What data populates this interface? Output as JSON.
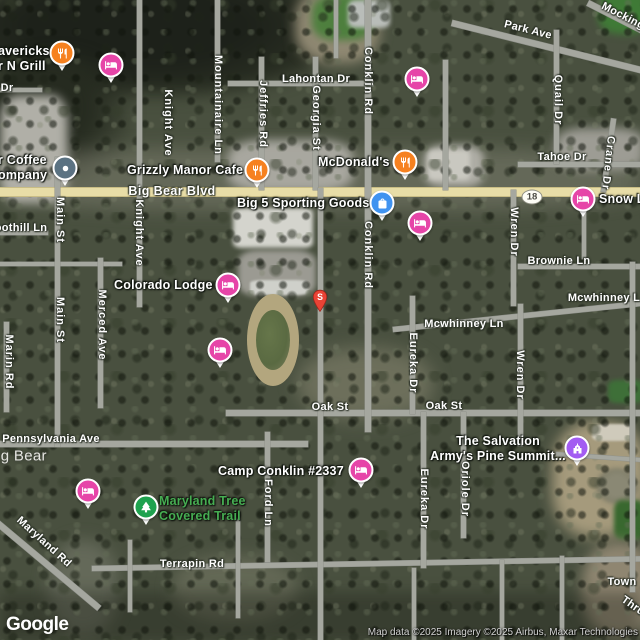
{
  "map": {
    "watermark": "Google",
    "attribution": "Map data ©2025 Imagery ©2025 Airbus, Maxar Technologies",
    "route_shield": {
      "number": "18",
      "x": 532,
      "y": 197
    },
    "colors": {
      "road_major": "#e8dda7",
      "road_minor": "#a5a79f",
      "pin_lodging": "#e645a8",
      "pin_restaurant": "#f68120",
      "pin_shopping": "#4093f0",
      "pin_generic": "#5b7282",
      "pin_worship": "#a35cf2",
      "pin_park": "#1fa24f",
      "marker_red": "#ea4335",
      "trail_label_green": "#46ad52",
      "city_label": "#e6e6e2"
    },
    "street_labels": [
      {
        "text": "Dr",
        "x": 7,
        "y": 88,
        "o": "h"
      },
      {
        "text": "Park Ave",
        "x": 528,
        "y": 30,
        "o": "h",
        "rot": 14
      },
      {
        "text": "Mocking",
        "x": 623,
        "y": 16,
        "o": "h",
        "rot": 27
      },
      {
        "text": "Lahontan Dr",
        "x": 316,
        "y": 79,
        "o": "h"
      },
      {
        "text": "Mountainaire Ln",
        "x": 218,
        "y": 105,
        "o": "v"
      },
      {
        "text": "Knight Ave",
        "x": 168,
        "y": 123,
        "o": "v"
      },
      {
        "text": "Jeffries Rd",
        "x": 263,
        "y": 114,
        "o": "v"
      },
      {
        "text": "Georgia St",
        "x": 316,
        "y": 118,
        "o": "v"
      },
      {
        "text": "Conklin Rd",
        "x": 368,
        "y": 81,
        "o": "v"
      },
      {
        "text": "Quail Dr",
        "x": 558,
        "y": 100,
        "o": "v"
      },
      {
        "text": "Tahoe Dr",
        "x": 562,
        "y": 157,
        "o": "h"
      },
      {
        "text": "Crane Dr",
        "x": 608,
        "y": 163,
        "o": "v",
        "rot": 6
      },
      {
        "text": "Big Bear Blvd",
        "x": 172,
        "y": 191,
        "o": "h",
        "variant": "major"
      },
      {
        "text": "oothill Ln",
        "x": 21,
        "y": 228,
        "o": "h"
      },
      {
        "text": "Main St",
        "x": 60,
        "y": 220,
        "o": "v"
      },
      {
        "text": "Knight Ave",
        "x": 139,
        "y": 233,
        "o": "v"
      },
      {
        "text": "Conklin Rd",
        "x": 368,
        "y": 255,
        "o": "v"
      },
      {
        "text": "Wren Dr",
        "x": 514,
        "y": 232,
        "o": "v"
      },
      {
        "text": "Brownie Ln",
        "x": 559,
        "y": 261,
        "o": "h"
      },
      {
        "text": "Mcwhinney L",
        "x": 604,
        "y": 298,
        "o": "h"
      },
      {
        "text": "Mcwhinney Ln",
        "x": 464,
        "y": 324,
        "o": "h"
      },
      {
        "text": "Main St",
        "x": 60,
        "y": 320,
        "o": "v"
      },
      {
        "text": "Merced Ave",
        "x": 102,
        "y": 325,
        "o": "v"
      },
      {
        "text": "Marin Rd",
        "x": 9,
        "y": 362,
        "o": "v"
      },
      {
        "text": "Eureka Dr",
        "x": 413,
        "y": 363,
        "o": "v"
      },
      {
        "text": "Wren Dr",
        "x": 520,
        "y": 375,
        "o": "v"
      },
      {
        "text": "Oak St",
        "x": 330,
        "y": 407,
        "o": "h"
      },
      {
        "text": "Oak St",
        "x": 444,
        "y": 406,
        "o": "h"
      },
      {
        "text": "Pennsylvania Ave",
        "x": 51,
        "y": 439,
        "o": "h"
      },
      {
        "text": "ig Bear",
        "x": 22,
        "y": 456,
        "o": "h",
        "variant": "city"
      },
      {
        "text": "Ford Ln",
        "x": 268,
        "y": 503,
        "o": "v"
      },
      {
        "text": "Eureka Dr",
        "x": 424,
        "y": 499,
        "o": "v"
      },
      {
        "text": "Oriole Dr",
        "x": 465,
        "y": 489,
        "o": "v"
      },
      {
        "text": "Maryland Rd",
        "x": 44,
        "y": 542,
        "o": "h",
        "rot": 42
      },
      {
        "text": "Terrapin Rd",
        "x": 192,
        "y": 564,
        "o": "h"
      },
      {
        "text": "Town",
        "x": 622,
        "y": 582,
        "o": "h"
      },
      {
        "text": "Thru",
        "x": 633,
        "y": 606,
        "o": "h",
        "rot": 35
      }
    ],
    "poi_labels": [
      {
        "name": "mavericks-grill-label",
        "lines": [
          "avericks",
          "r N Grill"
        ],
        "x": -2,
        "y": 44
      },
      {
        "name": "coffee-company-label",
        "lines": [
          "r Coffee",
          "ompany"
        ],
        "x": -2,
        "y": 153
      },
      {
        "name": "grizzly-manor-cafe-label",
        "lines": [
          "Grizzly Manor Cafe"
        ],
        "x": 127,
        "y": 163
      },
      {
        "name": "big5-sporting-goods-label",
        "lines": [
          "Big 5 Sporting Goods"
        ],
        "x": 237,
        "y": 196
      },
      {
        "name": "mcdonalds-label",
        "lines": [
          "McDonald's"
        ],
        "x": 318,
        "y": 155
      },
      {
        "name": "snow-lodge-label",
        "lines": [
          "Snow L"
        ],
        "x": 599,
        "y": 192
      },
      {
        "name": "colorado-lodge-label",
        "lines": [
          "Colorado Lodge"
        ],
        "x": 114,
        "y": 278
      },
      {
        "name": "camp-conklin-label",
        "lines": [
          "Camp Conklin #2337"
        ],
        "x": 218,
        "y": 464
      },
      {
        "name": "salvation-army-label",
        "lines": [
          "The Salvation",
          "Army's Pine Summit..."
        ],
        "x": 428,
        "y": 434,
        "w": 140,
        "align": "center"
      },
      {
        "name": "maryland-trail-label",
        "lines": [
          "Maryland Tree",
          "Covered Trail"
        ],
        "x": 159,
        "y": 494,
        "variant": "green"
      }
    ],
    "pins": [
      {
        "name": "mavericks-grill",
        "icon": "restaurant-icon",
        "color": "pin_restaurant",
        "x": 62,
        "y": 53
      },
      {
        "name": "lodging-1",
        "icon": "bed-icon",
        "color": "pin_lodging",
        "x": 111,
        "y": 65
      },
      {
        "name": "lodging-2",
        "icon": "bed-icon",
        "color": "pin_lodging",
        "x": 417,
        "y": 79
      },
      {
        "name": "coffee-company",
        "icon": "dot-icon",
        "color": "pin_generic",
        "x": 65,
        "y": 168
      },
      {
        "name": "grizzly-manor-cafe",
        "icon": "restaurant-icon",
        "color": "pin_restaurant",
        "x": 257,
        "y": 170
      },
      {
        "name": "mcdonalds",
        "icon": "restaurant-icon",
        "color": "pin_restaurant",
        "x": 405,
        "y": 162
      },
      {
        "name": "snow-lodge",
        "icon": "bed-icon",
        "color": "pin_lodging",
        "x": 583,
        "y": 199
      },
      {
        "name": "big5-sporting-goods",
        "icon": "shopping-bag-icon",
        "color": "pin_shopping",
        "x": 382,
        "y": 203
      },
      {
        "name": "lodging-3",
        "icon": "bed-icon",
        "color": "pin_lodging",
        "x": 420,
        "y": 223
      },
      {
        "name": "colorado-lodge",
        "icon": "bed-icon",
        "color": "pin_lodging",
        "x": 228,
        "y": 285
      },
      {
        "name": "lodging-4",
        "icon": "bed-icon",
        "color": "pin_lodging",
        "x": 220,
        "y": 350
      },
      {
        "name": "camp-conklin",
        "icon": "bed-icon",
        "color": "pin_lodging",
        "x": 361,
        "y": 470
      },
      {
        "name": "salvation-army-camp",
        "icon": "church-icon",
        "color": "pin_worship",
        "x": 577,
        "y": 448
      },
      {
        "name": "lodging-5",
        "icon": "bed-icon",
        "color": "pin_lodging",
        "x": 88,
        "y": 491
      },
      {
        "name": "maryland-trail",
        "icon": "tree-icon",
        "color": "pin_park",
        "x": 146,
        "y": 507
      }
    ],
    "search_marker": {
      "letter": "S",
      "x": 320,
      "y": 302
    }
  }
}
